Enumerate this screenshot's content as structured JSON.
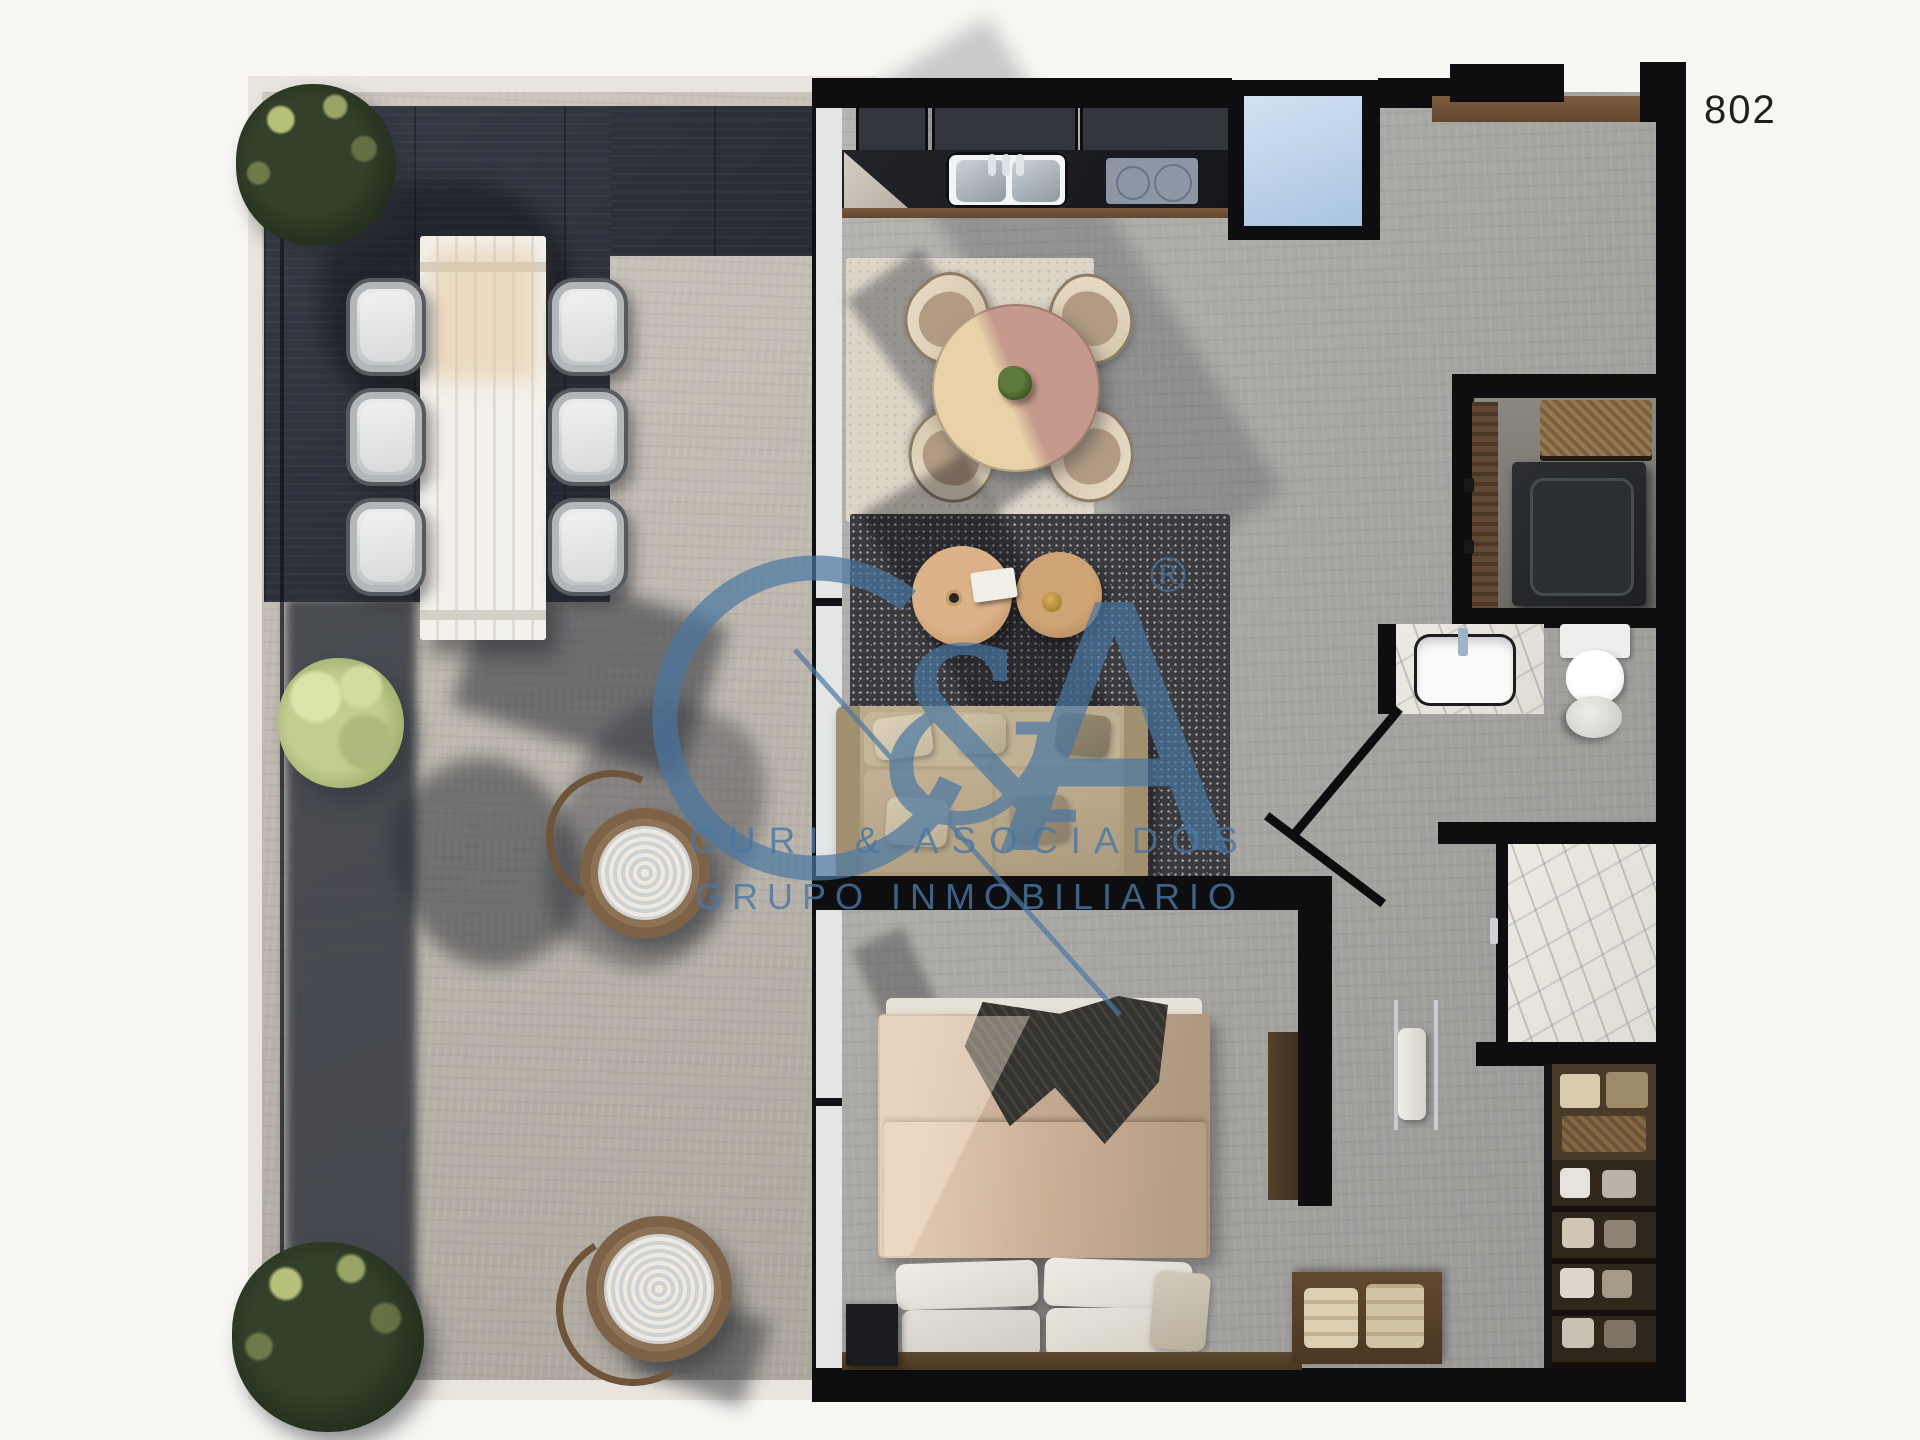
{
  "unit": {
    "label": "802"
  },
  "watermark": {
    "monogram_c": "C",
    "monogram_ampersand": "&",
    "monogram_a": "A",
    "registered_mark": "®",
    "line1": "CURI & ASOCIADOS",
    "line2": "GRUPO INMOBILIARIO",
    "color": "#4a77a3"
  },
  "palette": {
    "background": "#f8f7f4",
    "walls": "#0e0e11",
    "terrace_tile": "#2f333b",
    "terrace_stone": "#bdb7ae",
    "interior_floor": "#a9a7a4",
    "window_glass": "#b9d0e9",
    "wood_accent": "#6f523b",
    "dark_rug": "#3a3a3f",
    "light_rug": "#ddd6c8",
    "sofa": "#b5a385",
    "bed_linen": "#c4a88f",
    "marble": "#e9e6e0",
    "foliage_dark": "#33402a",
    "foliage_light": "#c2cd8f"
  }
}
